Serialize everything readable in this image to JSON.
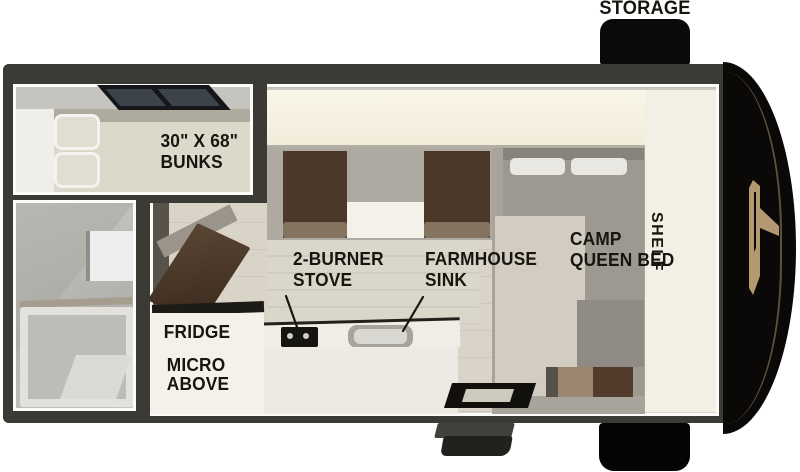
{
  "floorplan": {
    "title": "truck camper floor plan",
    "labels": {
      "storage": "STORAGE",
      "bunks1": "30\" X 68\"",
      "bunks2": "BUNKS",
      "stove1": "2-BURNER",
      "stove2": "STOVE",
      "sink1": "FARMHOUSE",
      "sink2": "SINK",
      "bed1": "CAMP",
      "bed2": "QUEEN BED",
      "fridge": "FRIDGE",
      "micro1": "MICRO",
      "micro2": "ABOVE",
      "shelf": "SHELF"
    },
    "colors": {
      "wall_charcoal": "#3b3a35",
      "floor_beige": "#d9d4c7",
      "cabinet_ivory": "#f6f2e2",
      "seat_brown": "#4b3828",
      "door_brown": "#5a4534",
      "bed_gray": "#9d9991",
      "exterior_black": "#0b0a08",
      "logo_gold": "#b29971",
      "label_text": "#17150f"
    }
  }
}
